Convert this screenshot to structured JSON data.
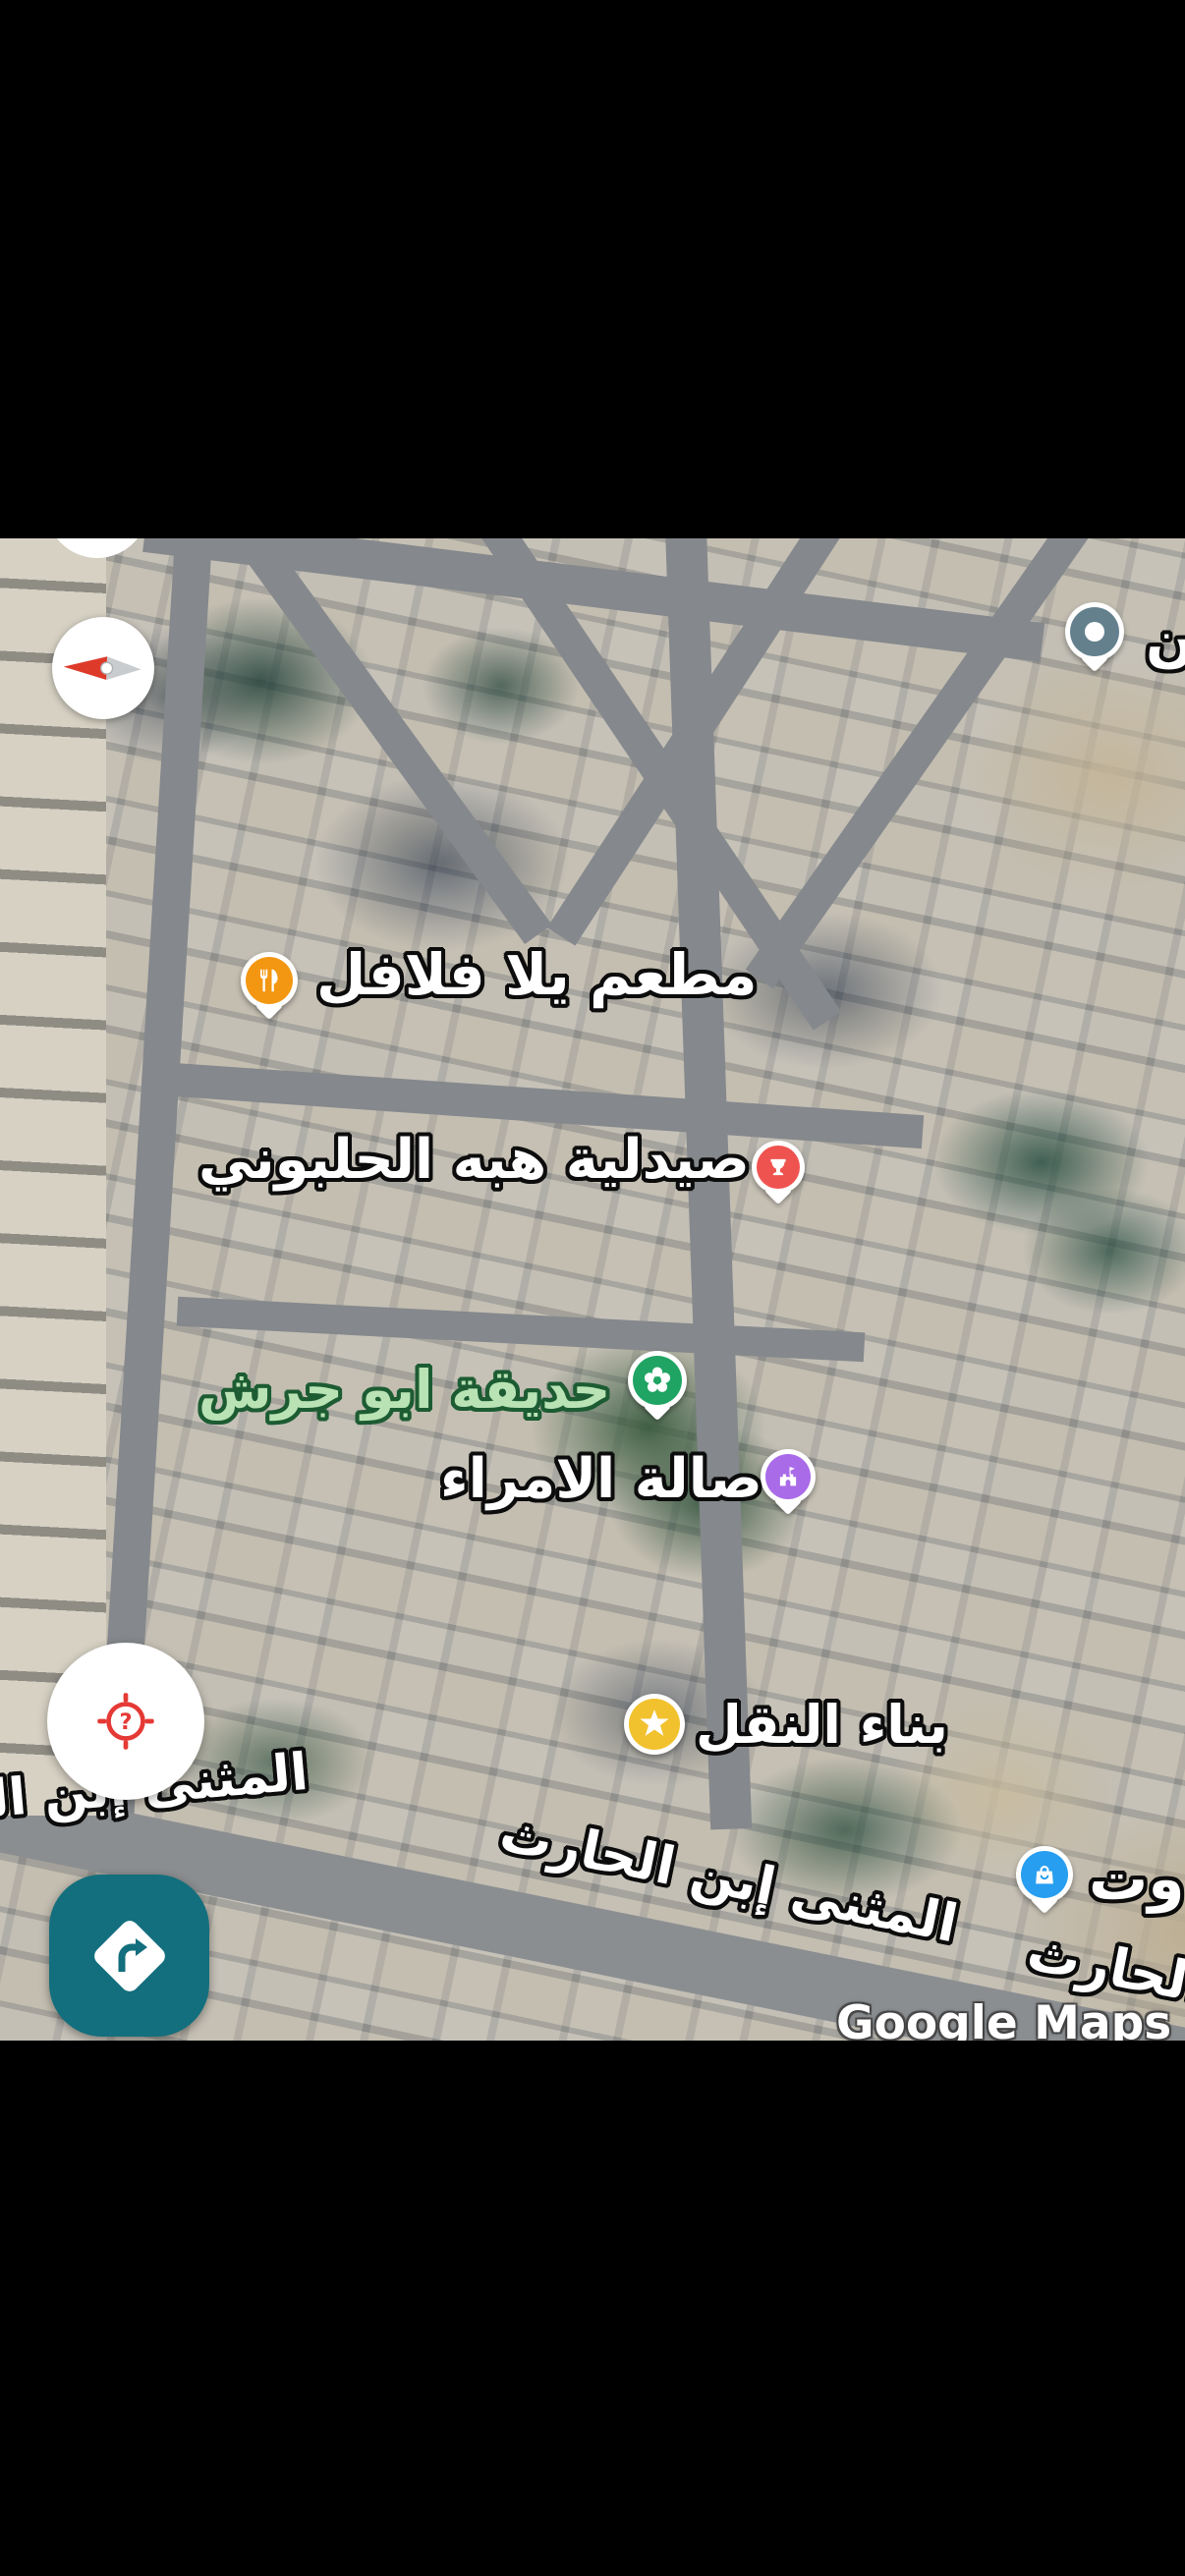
{
  "map": {
    "attribution": "Google Maps",
    "place_labels": [
      {
        "name": "restaurant",
        "text": "مطعم يلا فلافل",
        "marker_color": "#F39712",
        "icon": "restaurant-icon"
      },
      {
        "name": "pharmacy",
        "text": "صيدلية هبه الحلبوني",
        "marker_color": "#EF5350",
        "icon": "pharmacy-icon"
      },
      {
        "name": "park",
        "text": "حديقة ابو جرش",
        "marker_color": "#1FA463",
        "icon": "flower-icon",
        "text_color": "#B9E3B4",
        "text_outline": "#1D5C33"
      },
      {
        "name": "event-hall",
        "text": "صالة الامراء",
        "marker_color": "#A96BE8",
        "icon": "venue-icon"
      },
      {
        "name": "saved-place",
        "text": "بناء النقل",
        "marker_color": "#F2C12E",
        "icon": "star-icon"
      },
      {
        "name": "shopping-place",
        "text": "وت",
        "marker_color": "#279EF0",
        "icon": "shopping-bag-icon"
      },
      {
        "name": "generic-place",
        "text": "ن",
        "marker_color": "#64808D",
        "icon": "dot-icon"
      }
    ],
    "street_labels": [
      {
        "name": "street-main",
        "text": "المثنى إبن الحارث"
      },
      {
        "name": "street-left-partial",
        "text": "المثنى إبن الحارث"
      },
      {
        "name": "street-bottom-right-partial",
        "text": "المثنى إبن الحارث"
      }
    ]
  },
  "controls": {
    "locate": {
      "badge": "?"
    }
  },
  "colors": {
    "directions_button": "#136F7D",
    "locate_target_red": "#E53935",
    "compass_red": "#DD3A2A",
    "compass_gray": "#C9CCCF",
    "status_bar": "#000000"
  }
}
